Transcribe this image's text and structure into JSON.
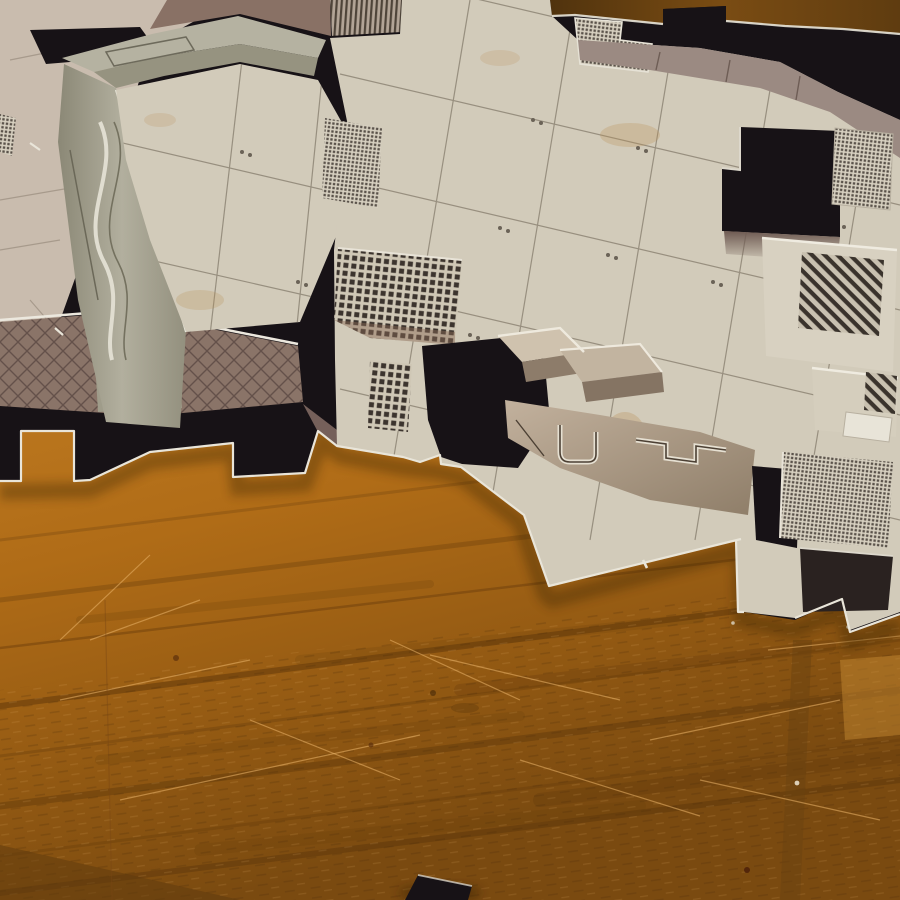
{
  "scene": {
    "title": "Sci-fi dungeon map tiles on a wooden table",
    "description": "Oblique overhead photograph of several interlocking die-cut cardboard map tiles from a sci-fi board game lying on an orange-grained wooden table. The tiles show beige metal-plate floor grids with rivets, black jigsaw-cut borders and doorway cutouts, grey-green and mauve-brown perspective walls with pipe conduits, fine mesh vent panels and diagonally hatched floor hatches. A loose black tile corner pokes into the frame at the bottom center.",
    "camera_angle": "oblique top-down, tiles filling the upper half",
    "lighting": "warm indoor light from the upper right casting soft shadows under the tile edges",
    "objects": [
      {
        "name": "back-left-tile",
        "description": "partially hidden tan tile under the front-left tile, top-left corner"
      },
      {
        "name": "front-left-room-tile",
        "description": "room tile with black border ring, grey-green pipe wall pillar, beige tiled floor and mauve lattice lower wall"
      },
      {
        "name": "main-right-tile",
        "description": "large tile with beige floor grid, black doorway cutouts, mesh vent panels, hatched hatches and taupe pipe walls"
      },
      {
        "name": "under-tile-fragment",
        "description": "mauve-walled tile edge with black border and puzzle notches, lower left"
      },
      {
        "name": "loose-corner-fragment",
        "description": "small black tile corner entering from the bottom edge of the frame"
      },
      {
        "name": "wooden-table",
        "description": "orange-brown wood surface with grain streaks, scratches, knots and plank seams"
      }
    ]
  },
  "palette": {
    "wood-light": "#c07c22",
    "wood-mid": "#a5661a",
    "wood-dark": "#7a4a10",
    "wood-shadow": "#5f3c10",
    "tile-black": "#171216",
    "tile-beige": "#d2cbba",
    "tile-beige-dark": "#b9b1a0",
    "wall-green-gray": "#a4a18f",
    "wall-mauve": "#8a7468",
    "wall-taupe": "#ab9886",
    "cut-edge": "#e9e5d9",
    "mesh-dark": "#4a423a",
    "grid-line": "#8e8575"
  }
}
